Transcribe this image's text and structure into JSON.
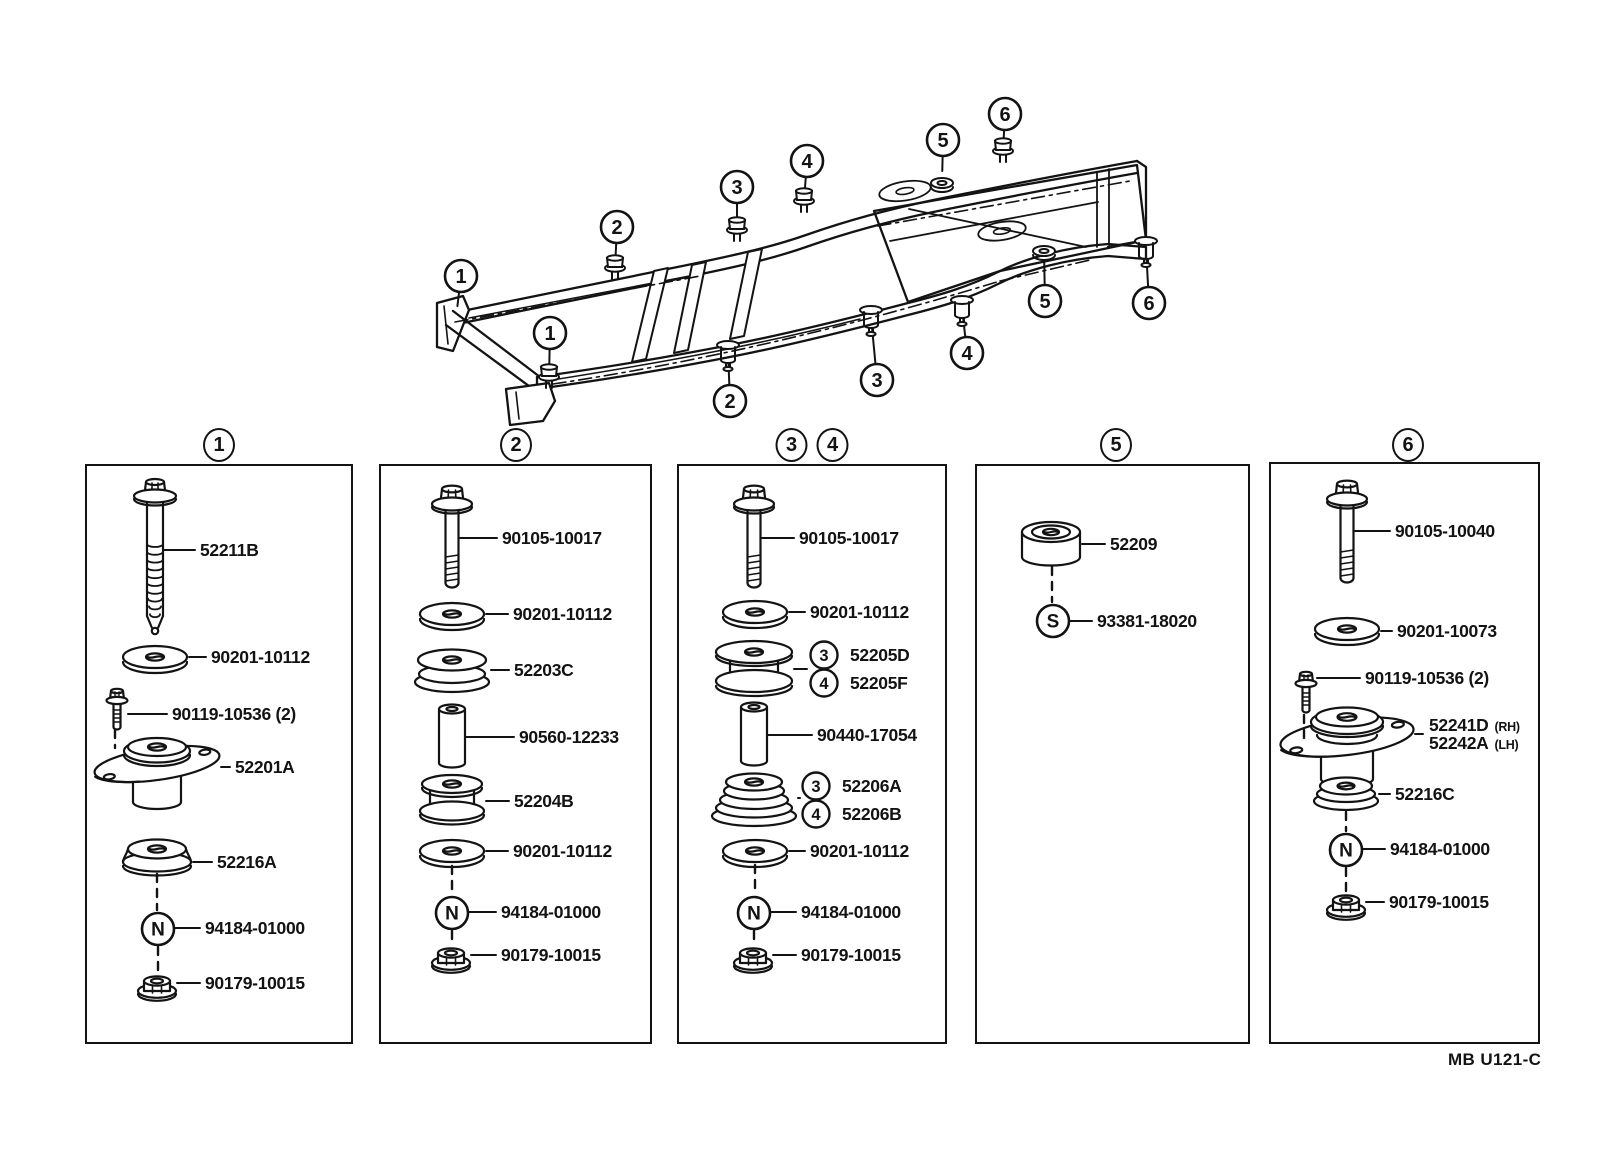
{
  "document": {
    "footer_code": "MB U121-C"
  },
  "frame_overview": {
    "callouts": [
      {
        "n": "1",
        "cx": 461,
        "cy": 276,
        "tx": 456,
        "ty": 318,
        "glyph": "none"
      },
      {
        "n": "1",
        "cx": 550,
        "cy": 333,
        "tx": 549,
        "ty": 377,
        "glyph": "stud"
      },
      {
        "n": "2",
        "cx": 617,
        "cy": 227,
        "tx": 615,
        "ty": 268,
        "glyph": "stud"
      },
      {
        "n": "3",
        "cx": 737,
        "cy": 187,
        "tx": 737,
        "ty": 230,
        "glyph": "stud"
      },
      {
        "n": "4",
        "cx": 807,
        "cy": 161,
        "tx": 804,
        "ty": 201,
        "glyph": "stud"
      },
      {
        "n": "5",
        "cx": 943,
        "cy": 140,
        "tx": 942,
        "ty": 183,
        "glyph": "grommet"
      },
      {
        "n": "6",
        "cx": 1005,
        "cy": 114,
        "tx": 1003,
        "ty": 151,
        "glyph": "stud"
      },
      {
        "n": "2",
        "cx": 730,
        "cy": 401,
        "tx": 728,
        "ty": 352,
        "glyph": "hanger"
      },
      {
        "n": "3",
        "cx": 877,
        "cy": 380,
        "tx": 871,
        "ty": 317,
        "glyph": "hanger"
      },
      {
        "n": "4",
        "cx": 967,
        "cy": 353,
        "tx": 962,
        "ty": 307,
        "glyph": "hanger"
      },
      {
        "n": "5",
        "cx": 1045,
        "cy": 301,
        "tx": 1044,
        "ty": 251,
        "glyph": "grommet"
      },
      {
        "n": "6",
        "cx": 1149,
        "cy": 303,
        "tx": 1146,
        "ty": 248,
        "glyph": "hanger"
      }
    ]
  },
  "panels": [
    {
      "numbers": [
        "1"
      ],
      "x": 85,
      "y": 464,
      "w": 268,
      "h": 580,
      "title_cx": [
        219
      ],
      "items": [
        {
          "icon": "bolt-long",
          "cx": 68,
          "y": 92,
          "label": {
            "text": "52211B",
            "x": 113,
            "y": 84
          }
        },
        {
          "icon": "washer",
          "cx": 68,
          "y": 191,
          "label": {
            "text": "90201-10112",
            "x": 124,
            "y": 191
          }
        },
        {
          "icon": "bolt-small",
          "cx": 30,
          "y": 246,
          "label": {
            "text": "90119-10536 (2)",
            "x": 85,
            "y": 248
          }
        },
        {
          "icon": "mount",
          "cx": 70,
          "y": 298,
          "label": {
            "text": "52201A",
            "x": 148,
            "y": 301
          }
        },
        {
          "icon": "cushion-dome",
          "cx": 70,
          "y": 391,
          "label": {
            "text": "52216A",
            "x": 130,
            "y": 396
          }
        },
        {
          "icon": "circle-letter",
          "letter": "N",
          "cx": 71,
          "y": 463,
          "label": {
            "text": "94184-01000",
            "x": 118,
            "y": 462
          }
        },
        {
          "icon": "nut",
          "cx": 70,
          "y": 519,
          "label": {
            "text": "90179-10015",
            "x": 118,
            "y": 517
          }
        }
      ],
      "connectors": [
        {
          "x": 28,
          "y1": 264,
          "y2": 282
        },
        {
          "x": 70,
          "y1": 408,
          "y2": 444
        },
        {
          "x": 71,
          "y1": 481,
          "y2": 506
        }
      ]
    },
    {
      "numbers": [
        "2"
      ],
      "x": 379,
      "y": 464,
      "w": 273,
      "h": 580,
      "title_cx": [
        516
      ],
      "items": [
        {
          "icon": "bolt",
          "cx": 71,
          "y": 71,
          "label": {
            "text": "90105-10017",
            "x": 121,
            "y": 72
          }
        },
        {
          "icon": "washer",
          "cx": 71,
          "y": 148,
          "label": {
            "text": "90201-10112",
            "x": 132,
            "y": 148
          }
        },
        {
          "icon": "grommet",
          "cx": 71,
          "y": 201,
          "label": {
            "text": "52203C",
            "x": 133,
            "y": 204
          }
        },
        {
          "icon": "collar",
          "cx": 71,
          "y": 271,
          "label": {
            "text": "90560-12233",
            "x": 138,
            "y": 271
          }
        },
        {
          "icon": "spool",
          "cx": 71,
          "y": 333,
          "label": {
            "text": "52204B",
            "x": 133,
            "y": 335
          }
        },
        {
          "icon": "washer",
          "cx": 71,
          "y": 385,
          "label": {
            "text": "90201-10112",
            "x": 132,
            "y": 385
          }
        },
        {
          "icon": "circle-letter",
          "letter": "N",
          "cx": 71,
          "y": 447,
          "label": {
            "text": "94184-01000",
            "x": 120,
            "y": 446
          }
        },
        {
          "icon": "nut",
          "cx": 70,
          "y": 491,
          "label": {
            "text": "90179-10015",
            "x": 120,
            "y": 489
          }
        }
      ],
      "connectors": [
        {
          "x": 71,
          "y1": 400,
          "y2": 428
        },
        {
          "x": 71,
          "y1": 465,
          "y2": 478
        }
      ]
    },
    {
      "numbers": [
        "3",
        "4"
      ],
      "x": 677,
      "y": 464,
      "w": 270,
      "h": 580,
      "title_cx": [
        793,
        831
      ],
      "items": [
        {
          "icon": "bolt",
          "cx": 75,
          "y": 71,
          "label": {
            "text": "90105-10017",
            "x": 120,
            "y": 72
          }
        },
        {
          "icon": "washer",
          "cx": 76,
          "y": 146,
          "label": {
            "text": "90201-10112",
            "x": 131,
            "y": 146
          }
        },
        {
          "icon": "pulley",
          "cx": 75,
          "y": 203,
          "labels": [
            {
              "badge": "3",
              "text": "52205D",
              "x": 171,
              "y": 189
            },
            {
              "badge": "4",
              "text": "52205F",
              "x": 171,
              "y": 217
            }
          ]
        },
        {
          "icon": "collar",
          "cx": 75,
          "y": 269,
          "label": {
            "text": "90440-17054",
            "x": 138,
            "y": 269
          }
        },
        {
          "icon": "cone",
          "cx": 75,
          "y": 332,
          "labels": [
            {
              "badge": "3",
              "text": "52206A",
              "x": 163,
              "y": 320
            },
            {
              "badge": "4",
              "text": "52206B",
              "x": 163,
              "y": 348
            }
          ]
        },
        {
          "icon": "washer",
          "cx": 76,
          "y": 385,
          "label": {
            "text": "90201-10112",
            "x": 131,
            "y": 385
          }
        },
        {
          "icon": "circle-letter",
          "letter": "N",
          "cx": 75,
          "y": 447,
          "label": {
            "text": "94184-01000",
            "x": 122,
            "y": 446
          }
        },
        {
          "icon": "nut",
          "cx": 74,
          "y": 491,
          "label": {
            "text": "90179-10015",
            "x": 122,
            "y": 489
          }
        }
      ],
      "connectors": [
        {
          "x": 76,
          "y1": 399,
          "y2": 428
        },
        {
          "x": 75,
          "y1": 465,
          "y2": 478
        }
      ]
    },
    {
      "numbers": [
        "5"
      ],
      "x": 975,
      "y": 464,
      "w": 275,
      "h": 580,
      "title_cx": [
        1116
      ],
      "items": [
        {
          "icon": "cushion-round",
          "cx": 74,
          "y": 78,
          "label": {
            "text": "52209",
            "x": 133,
            "y": 78
          }
        },
        {
          "icon": "circle-letter",
          "letter": "S",
          "cx": 76,
          "y": 155,
          "label": {
            "text": "93381-18020",
            "x": 120,
            "y": 155
          }
        }
      ],
      "connectors": [
        {
          "x": 75,
          "y1": 101,
          "y2": 136
        }
      ]
    },
    {
      "numbers": [
        "6"
      ],
      "x": 1269,
      "y": 462,
      "w": 271,
      "h": 582,
      "title_cx": [
        1408
      ],
      "items": [
        {
          "icon": "bolt",
          "cx": 76,
          "y": 68,
          "label": {
            "text": "90105-10040",
            "x": 124,
            "y": 67
          }
        },
        {
          "icon": "washer",
          "cx": 76,
          "y": 165,
          "label": {
            "text": "90201-10073",
            "x": 126,
            "y": 167
          }
        },
        {
          "icon": "bolt-small",
          "cx": 35,
          "y": 231,
          "label": {
            "text": "90119-10536 (2)",
            "x": 94,
            "y": 214
          }
        },
        {
          "icon": "mount-plate",
          "cx": 76,
          "y": 273,
          "labels": [
            {
              "text": "52241D",
              "suffix": "(RH)",
              "x": 158,
              "y": 261
            },
            {
              "text": "52242A",
              "suffix": "(LH)",
              "x": 158,
              "y": 279
            }
          ]
        },
        {
          "icon": "cushion-rib",
          "cx": 75,
          "y": 330,
          "label": {
            "text": "52216C",
            "x": 124,
            "y": 330
          }
        },
        {
          "icon": "circle-letter",
          "letter": "N",
          "cx": 75,
          "y": 386,
          "label": {
            "text": "94184-01000",
            "x": 119,
            "y": 385
          }
        },
        {
          "icon": "nut",
          "cx": 75,
          "y": 440,
          "label": {
            "text": "90179-10015",
            "x": 118,
            "y": 438
          }
        }
      ],
      "connectors": [
        {
          "x": 33,
          "y1": 251,
          "y2": 277
        },
        {
          "x": 75,
          "y1": 348,
          "y2": 367
        },
        {
          "x": 75,
          "y1": 404,
          "y2": 427
        }
      ]
    }
  ]
}
